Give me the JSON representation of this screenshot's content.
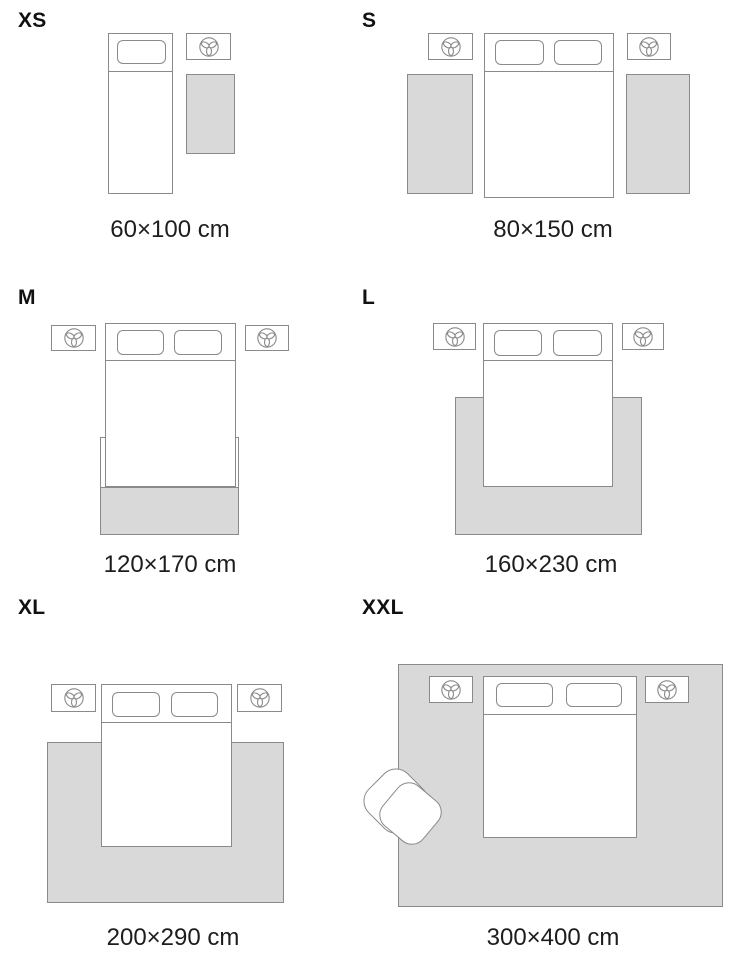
{
  "title": "Rug size guide",
  "colors": {
    "background": "#ffffff",
    "outline": "#8a8a8a",
    "rug_fill": "#d9d9d9",
    "label_text": "#111111",
    "caption_text": "#1d1d1d"
  },
  "icons": {
    "nightstand": "plant-icon"
  },
  "panels": [
    {
      "id": "xs",
      "label": "XS",
      "caption": "60×100 cm",
      "scene": {
        "beds": 1,
        "nightstands": 1,
        "rugs": 1,
        "armchair": false
      }
    },
    {
      "id": "s",
      "label": "S",
      "caption": "80×150 cm",
      "scene": {
        "beds": 1,
        "nightstands": 2,
        "rugs": 2,
        "armchair": false
      }
    },
    {
      "id": "m",
      "label": "M",
      "caption": "120×170 cm",
      "scene": {
        "beds": 1,
        "nightstands": 2,
        "rugs": 1,
        "armchair": false
      }
    },
    {
      "id": "l",
      "label": "L",
      "caption": "160×230 cm",
      "scene": {
        "beds": 1,
        "nightstands": 2,
        "rugs": 1,
        "armchair": false
      }
    },
    {
      "id": "xl",
      "label": "XL",
      "caption": "200×290 cm",
      "scene": {
        "beds": 1,
        "nightstands": 2,
        "rugs": 1,
        "armchair": false
      }
    },
    {
      "id": "xxl",
      "label": "XXL",
      "caption": "300×400 cm",
      "scene": {
        "beds": 1,
        "nightstands": 2,
        "rugs": 1,
        "armchair": true
      }
    }
  ]
}
